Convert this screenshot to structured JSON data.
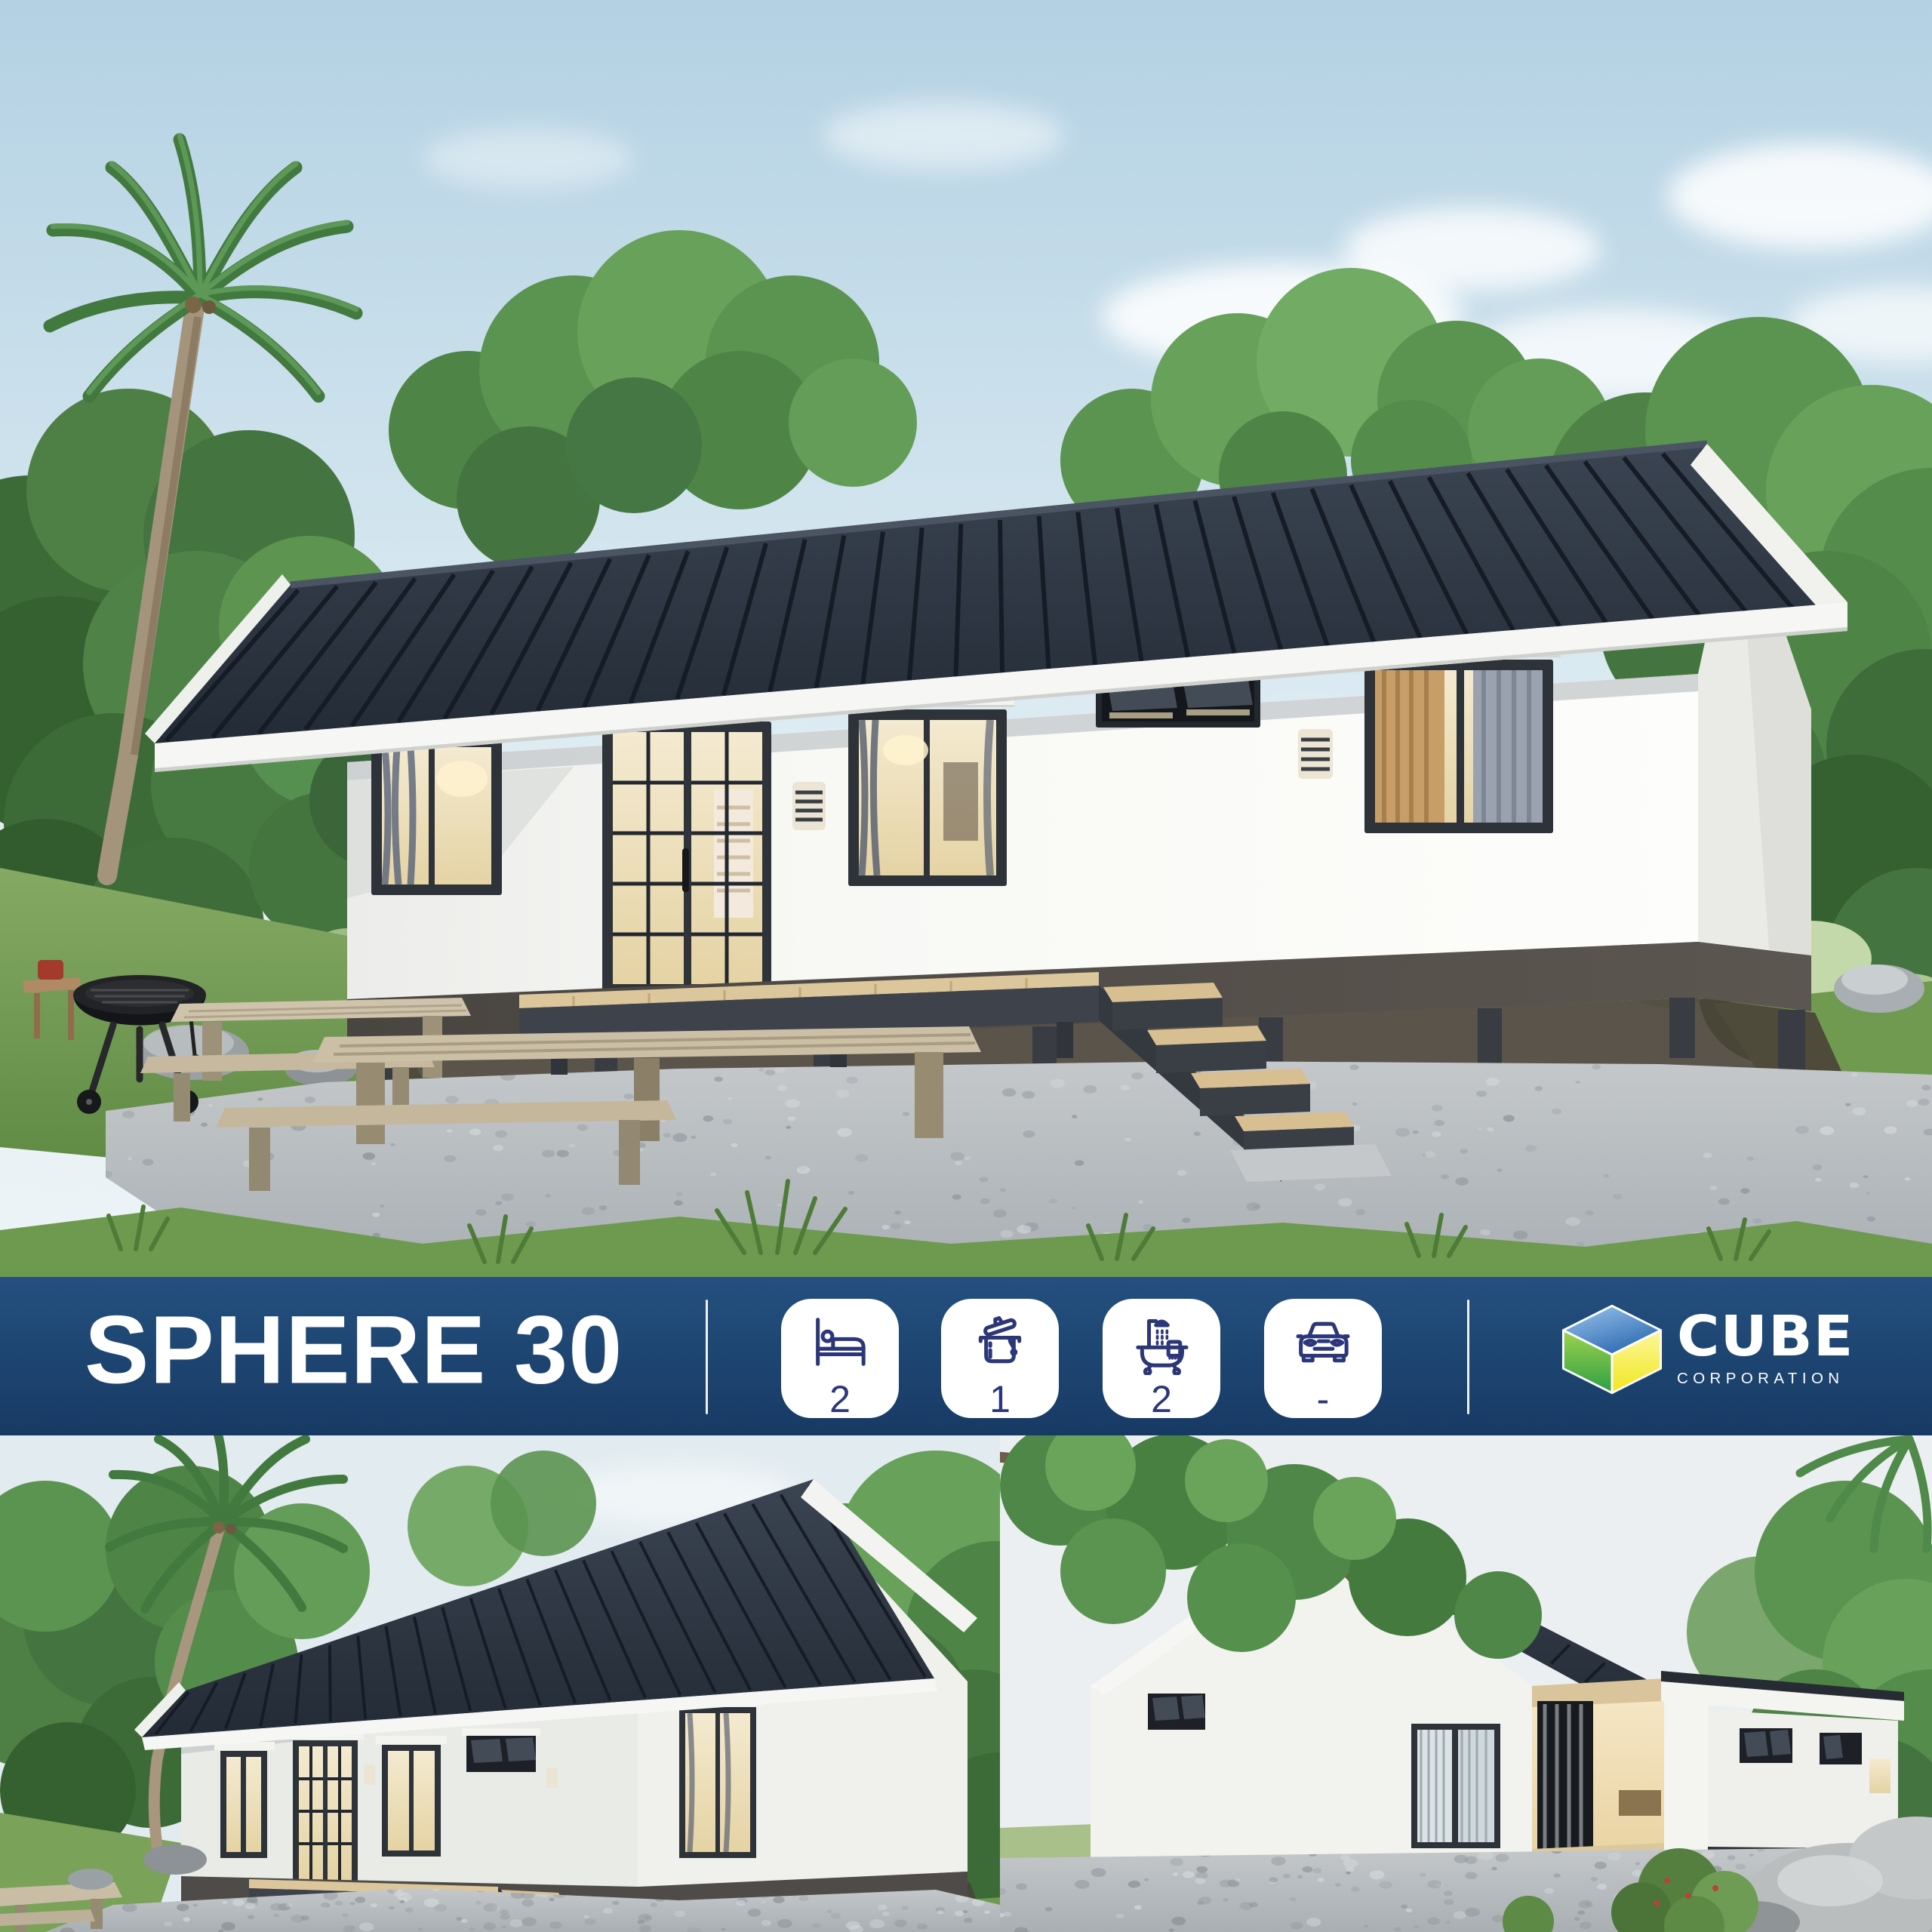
{
  "banner": {
    "model_name": "SPHERE 30",
    "specs": [
      {
        "name": "bedrooms",
        "icon": "bed-icon",
        "value": "2"
      },
      {
        "name": "kitchen",
        "icon": "cooking-pot-icon",
        "value": "1"
      },
      {
        "name": "bathrooms",
        "icon": "bathtub-icon",
        "value": "2"
      },
      {
        "name": "parking",
        "icon": "car-icon",
        "value": "-"
      }
    ],
    "brand": {
      "name": "CUBE",
      "subtitle": "CORPORATION"
    }
  },
  "renders": {
    "hero": "front elevation render of SPHERE 30 house",
    "bottom_left": "angled front-left render",
    "bottom_right": "rear terrace render"
  },
  "colors": {
    "banner_top": "#24507f",
    "banner_mid": "#1d4470",
    "banner_bottom": "#173a64",
    "tile_bg": "#ffffff",
    "icon_ink": "#2b3779",
    "text_white": "#ffffff",
    "roof": "#2d3541",
    "wall": "#f6f6f3",
    "plinth": "#55504b",
    "warm_light": "#ecdfb6",
    "logo_blue": "#3f7cc0",
    "logo_green": "#46a648",
    "logo_yellow": "#f2e93c"
  }
}
